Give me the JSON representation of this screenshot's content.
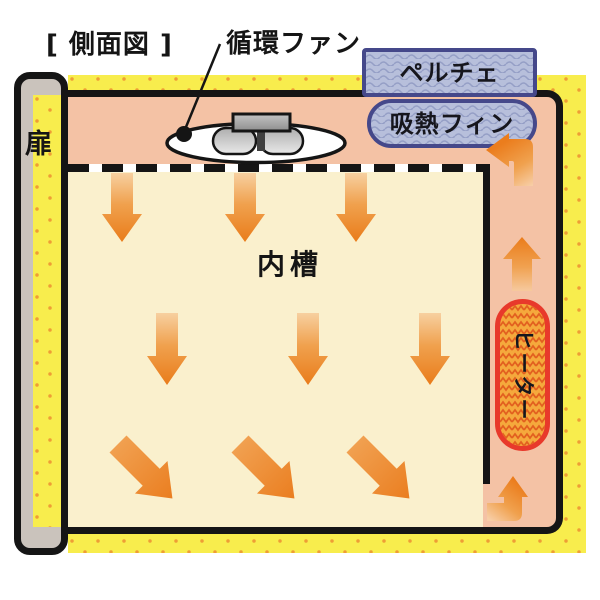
{
  "labels": {
    "side_view": "[ 側面図 ]",
    "circulation_fan": "循環ファン",
    "peltier": "ペルチェ",
    "heat_absorption_fin": "吸熱フィン",
    "door": "扉",
    "inner_tank": "内槽",
    "heater": "ヒーター"
  },
  "airflow": {
    "down_arrows_top_row": 3,
    "down_arrows_middle_row": 3,
    "diagonal_arrows_bottom_row": 3,
    "up_arrow_right_channel": 1,
    "corner_turn_arrows": 2,
    "arrow_color": "#ED8A2C"
  },
  "colors": {
    "insulation_yellow": "#F8ED4D",
    "insulation_dot_orange": "#EE9E35",
    "air_channel_pink": "#F4C2A5",
    "inner_tank_cream": "#FAF0CD",
    "door_gray": "#CAC3BC",
    "peltier_fill_blue": "#B7BFDB",
    "peltier_border_navy": "#45488A",
    "heater_fill_orange": "#F5A93C",
    "heater_border_red": "#E8392B",
    "outline_black": "#151515"
  }
}
